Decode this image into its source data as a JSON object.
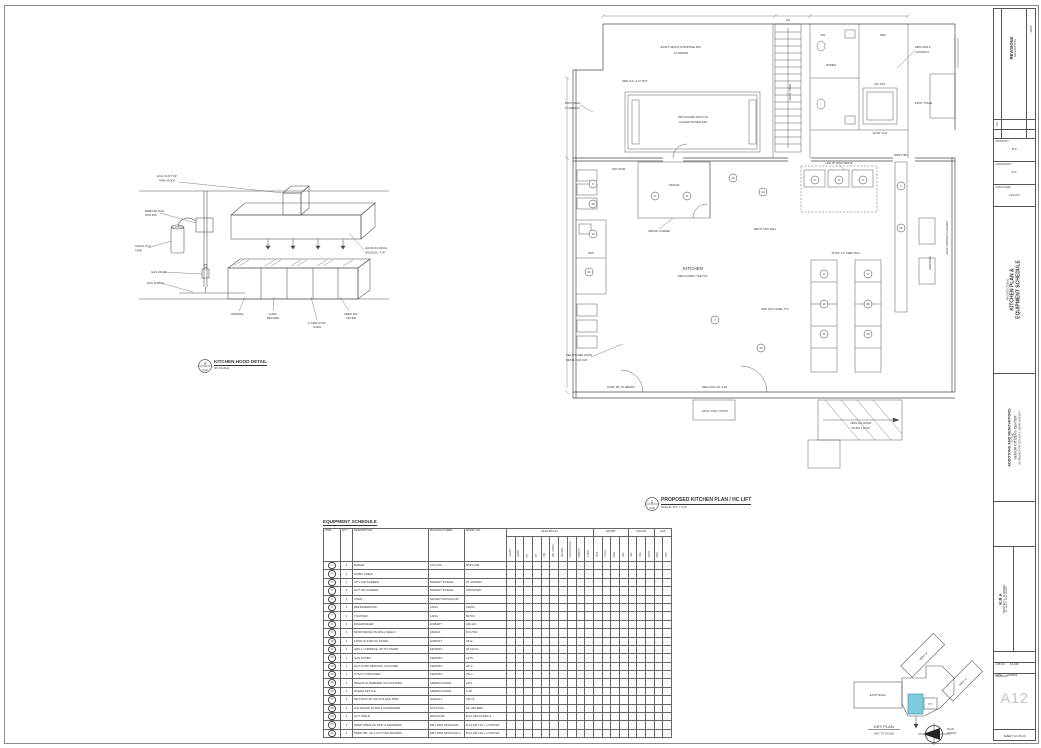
{
  "title_strip": {
    "revisions": {
      "no": "NO.",
      "title": "REVISIONS",
      "description": "DESCRIPTION",
      "date": "DATE"
    },
    "fields": [
      {
        "label": "DRAWN BY",
        "value": "M.F."
      },
      {
        "label": "CHECKED BY",
        "value": "R.K."
      },
      {
        "label": "CADD NAME",
        "value": "A12-KIT"
      }
    ],
    "discipline": "ARCHITECTURAL",
    "sheet_title": [
      "KITCHEN PLAN &",
      "EQUIPMENT SCHEDULE"
    ],
    "project": [
      "ADDITIONS AND RENOVATIONS",
      "TO THE",
      "SENIOR CITIZENS CENTER",
      "BURLINGTON COUNTY, NEW JERSEY"
    ],
    "architect": [
      "K R A",
      "ARCHITECTS - PLANNERS",
      "MT. HOLLY, NEW JERSEY"
    ],
    "job": {
      "label": "JOB NO.",
      "value": "94-026"
    },
    "date": {
      "label": "DATE",
      "value": "10/26/04"
    },
    "drawing_label": "DRAWING",
    "sheet_no": "A12",
    "sheet_of": "SHEET 12 OF 24"
  },
  "hood_detail": {
    "marker": "4",
    "marker_sheet": "A12",
    "caption": "KITCHEN HOOD DETAIL",
    "scale": "NO SCALE",
    "labels": [
      {
        "x": 34,
        "y": 14,
        "t": "EXH. DUCT UP",
        "s": 2.8
      },
      {
        "x": 34,
        "y": 18.5,
        "t": "THRU ROOF",
        "s": 2.8
      },
      {
        "x": 12,
        "y": 49,
        "t": "REMOTE PULL",
        "a": "start",
        "s": 2.8
      },
      {
        "x": 12,
        "y": 53,
        "t": "STATION",
        "a": "start",
        "s": 2.8
      },
      {
        "x": 2,
        "y": 84,
        "t": "ANSUL SYS.",
        "a": "start",
        "s": 2.8
      },
      {
        "x": 2,
        "y": 88.5,
        "t": "TANK",
        "a": "start",
        "s": 2.8
      },
      {
        "x": 18,
        "y": 110,
        "t": "GAS VALVE",
        "a": "start",
        "s": 2.8
      },
      {
        "x": 14,
        "y": 121,
        "t": "GAS SUPPLY",
        "a": "start",
        "s": 2.8
      },
      {
        "x": 232,
        "y": 86,
        "t": "HOOD W/ ANSUL",
        "a": "start",
        "s": 2.8
      },
      {
        "x": 232,
        "y": 90.5,
        "t": "NOZZLES, TYP.",
        "a": "start",
        "s": 2.8
      },
      {
        "x": 104,
        "y": 152,
        "t": "GRIDDLE",
        "s": 2.8
      },
      {
        "x": 140,
        "y": 152,
        "t": "CHAR-",
        "s": 2.8
      },
      {
        "x": 140,
        "y": 156,
        "t": "BROILER",
        "s": 2.8
      },
      {
        "x": 184,
        "y": 161,
        "t": "2-TIER CONV.",
        "s": 2.8
      },
      {
        "x": 184,
        "y": 165,
        "t": "OVEN",
        "s": 2.8
      },
      {
        "x": 218,
        "y": 152,
        "t": "DEEP FAT",
        "s": 2.8
      },
      {
        "x": 218,
        "y": 156,
        "t": "FRYER",
        "s": 2.8
      }
    ]
  },
  "kitchen_plan": {
    "marker": "1",
    "marker_sheet": "A12",
    "caption": "PROPOSED KITCHEN PLAN / HC LIFT",
    "scale": "SCALE: 1/4\" = 1'-0\"",
    "labels": [
      {
        "x": 118,
        "y": 40,
        "t": "EXIST. MULTI-PURPOSE RM.",
        "s": 3
      },
      {
        "x": 118,
        "y": 46,
        "t": "TO REMAIN",
        "s": 2.6
      },
      {
        "x": 130,
        "y": 110,
        "t": "RELOCATED WALK-IN",
        "s": 2.8
      },
      {
        "x": 130,
        "y": 115,
        "t": "COOLER ON NEW PAD",
        "s": 2.6
      },
      {
        "x": 72,
        "y": 74,
        "t": "NEW CLG. & LT. FIXT.",
        "s": 2.6
      },
      {
        "x": 2,
        "y": 96,
        "t": "EXIST. WALL",
        "a": "start",
        "s": 2.6
      },
      {
        "x": 2,
        "y": 101,
        "t": "TO REMAIN",
        "a": "start",
        "s": 2.6
      },
      {
        "x": 228,
        "y": 84,
        "t": "EXIST. STAIR",
        "r": -90,
        "s": 2.6
      },
      {
        "x": 225,
        "y": 13,
        "t": "DN",
        "s": 2.5
      },
      {
        "x": 260,
        "y": 28,
        "t": "JAN.",
        "s": 2.6
      },
      {
        "x": 268,
        "y": 58,
        "t": "WOMEN",
        "s": 2.6
      },
      {
        "x": 320,
        "y": 28,
        "t": "MEN",
        "s": 2.6
      },
      {
        "x": 317,
        "y": 77,
        "t": "H/C LIFT",
        "s": 2.8
      },
      {
        "x": 317,
        "y": 126,
        "t": "42\"x60\" CLR.",
        "s": 2.5
      },
      {
        "x": 352,
        "y": 40,
        "t": "NEW GATE &",
        "a": "start",
        "s": 2.5
      },
      {
        "x": 352,
        "y": 45,
        "t": "CONTROLS",
        "a": "start",
        "s": 2.5
      },
      {
        "x": 352,
        "y": 96,
        "t": "EXIST. STAGE",
        "a": "start",
        "s": 2.6
      },
      {
        "x": 111,
        "y": 178,
        "t": "OFFICE",
        "s": 3
      },
      {
        "x": 56,
        "y": 162,
        "t": "DRY STOR.",
        "s": 2.6
      },
      {
        "x": 28,
        "y": 246,
        "t": "MOP",
        "s": 2.5
      },
      {
        "x": 130,
        "y": 262,
        "t": "KITCHEN",
        "s": 4.6
      },
      {
        "x": 130,
        "y": 269,
        "t": "NEW QUARRY TILE FLR.",
        "s": 2.6
      },
      {
        "x": 283,
        "y": 246,
        "t": "36\"x84\" S.S. PREP TBLS.",
        "s": 2.5
      },
      {
        "x": 276,
        "y": 156,
        "t": "LINE OF HOOD ABOVE",
        "s": 2.5
      },
      {
        "x": 338,
        "y": 148,
        "t": "PASS-THRU",
        "s": 2.5
      },
      {
        "x": 368,
        "y": 255,
        "t": "SERVING",
        "r": -90,
        "s": 3
      },
      {
        "x": 3,
        "y": 348,
        "t": "SEE KITCHEN HOOD",
        "a": "start",
        "s": 2.6
      },
      {
        "x": 3,
        "y": 353,
        "t": "DETAIL THIS SHT.",
        "a": "start",
        "s": 2.6
      },
      {
        "x": 152,
        "y": 380,
        "t": "NEW ALUM. DR. & FR.",
        "s": 2.5
      },
      {
        "x": 58,
        "y": 380,
        "t": "EXIST. DR. TO REMAIN",
        "s": 2.5
      },
      {
        "x": 298,
        "y": 416,
        "t": "NEW H/C RAMP",
        "s": 2.8
      },
      {
        "x": 298,
        "y": 421,
        "t": "SLOPE 1:12 DN.",
        "s": 2.5
      },
      {
        "x": 152,
        "y": 404,
        "t": "EXIST. CONC. STOOP",
        "s": 2.5
      },
      {
        "x": 212,
        "y": 302,
        "t": "NEW VINYL BASE, TYP.",
        "s": 2.5
      },
      {
        "x": 385,
        "y": 230,
        "t": "EXIST. WINDOW TO REMAIN",
        "r": -90,
        "s": 2.5
      },
      {
        "x": 202,
        "y": 222,
        "t": "NEW 8\" CMU WALL",
        "s": 2.5
      },
      {
        "x": 96,
        "y": 224,
        "t": "NEW DR. & FRAME",
        "s": 2.4
      }
    ],
    "callouts": [
      {
        "x": 30,
        "y": 176,
        "n": "6"
      },
      {
        "x": 30,
        "y": 196,
        "n": "15"
      },
      {
        "x": 30,
        "y": 226,
        "n": "12"
      },
      {
        "x": 26,
        "y": 264,
        "n": "21"
      },
      {
        "x": 92,
        "y": 188,
        "n": "5"
      },
      {
        "x": 124,
        "y": 188,
        "n": "8"
      },
      {
        "x": 170,
        "y": 170,
        "n": "16"
      },
      {
        "x": 200,
        "y": 184,
        "n": "14"
      },
      {
        "x": 252,
        "y": 172,
        "n": "2"
      },
      {
        "x": 276,
        "y": 172,
        "n": "3"
      },
      {
        "x": 300,
        "y": 172,
        "n": "4"
      },
      {
        "x": 261,
        "y": 266,
        "n": "9"
      },
      {
        "x": 261,
        "y": 296,
        "n": "10"
      },
      {
        "x": 261,
        "y": 326,
        "n": "11"
      },
      {
        "x": 305,
        "y": 266,
        "n": "17"
      },
      {
        "x": 305,
        "y": 296,
        "n": "18"
      },
      {
        "x": 305,
        "y": 326,
        "n": "19"
      },
      {
        "x": 338,
        "y": 178,
        "n": "1"
      },
      {
        "x": 338,
        "y": 220,
        "n": "20"
      },
      {
        "x": 152,
        "y": 312,
        "n": "7"
      },
      {
        "x": 198,
        "y": 340,
        "n": "13"
      }
    ]
  },
  "equipment_schedule": {
    "title": "EQUIPMENT SCHEDULE",
    "columns": [
      "ITEM",
      "QTY",
      "DESCRIPTION",
      "MANUFACTURER",
      "MODEL NO."
    ],
    "groups": [
      {
        "label": "ELECTRICAL",
        "subs": [
          "VOLTS",
          "AMPS",
          "PH",
          "HP",
          "KW",
          "DIR. CONN.",
          "RECEPT.",
          "CORD & PLUG",
          "SWITCH",
          "J-BOX"
        ]
      },
      {
        "label": "WATER",
        "subs": [
          "HOT",
          "COLD",
          "SIZE",
          "IND."
        ]
      },
      {
        "label": "WASTE",
        "subs": [
          "DIR.",
          "IND.",
          "VENT"
        ]
      },
      {
        "label": "GAS",
        "subs": [
          "SIZE",
          "BTU"
        ]
      }
    ],
    "rows": [
      [
        "1",
        "1",
        "RANGE",
        "VULCAN",
        "60SS-10B"
      ],
      [
        "2",
        "1",
        "WORK SHELF",
        "",
        ""
      ],
      [
        "3",
        "1",
        "CITY AIR SCREEN",
        "MARKET FORGE",
        "KT-1000000"
      ],
      [
        "4",
        "4",
        "HOT AIR SCREEN",
        "MARKET FORGE",
        "UNKNOWN"
      ],
      [
        "5",
        "1",
        "OVEN",
        "MAGIKITCH'N EQUIP.",
        ""
      ],
      [
        "6",
        "1",
        "REFRIGERATOR",
        "LANG",
        "K2000"
      ],
      [
        "7",
        "1",
        "TOASTER",
        "LANG",
        "B470U"
      ],
      [
        "8",
        "1",
        "DISHWASHER",
        "HOBART",
        "AM-14C"
      ],
      [
        "9",
        "1",
        "MICROWAVE ON WALL SHELF",
        "AMANA",
        "RC17SD"
      ],
      [
        "10",
        "1",
        "FOOD SLICER W/ STAND",
        "HOBART",
        "2912"
      ],
      [
        "11",
        "1",
        "GRILL / GRIDDLE, 36\" W/ STAND",
        "KEATING",
        "36 FLD-E"
      ],
      [
        "12",
        "1",
        "GAS FRYER",
        "KEATING",
        "14TS"
      ],
      [
        "13",
        "1",
        "HOT FOOD SERVING COUNTER",
        "KEATING",
        "HF-4"
      ],
      [
        "14",
        "1",
        "UTILITY DISPOSER",
        "KEATING",
        "UD-1"
      ],
      [
        "15",
        "1",
        "REACH-IN FREEZER ON CASTERS",
        "AMERIKOOLER",
        "FR-1"
      ],
      [
        "16",
        "1",
        "STEAM KETTLE",
        "AMERIKOOLER",
        "K-60"
      ],
      [
        "17",
        "1",
        "MILK BOX W/ COLD PLATE TRIM",
        "DUNHILL",
        "TM-74"
      ],
      [
        "18",
        "1",
        "ICE MAKER W/ BIN & DISPENSER",
        "NATIONAL",
        "ML-350-MED"
      ],
      [
        "19",
        "1",
        "HOT TABLE",
        "MODULAR",
        "B-12-MFCM-SRA-4"
      ],
      [
        "20",
        "1",
        "PREP TABLE W/ SINK & DRAWERS",
        "MET-PRO MODULAR",
        "B-12-MFT-SL + CUSTOM"
      ],
      [
        "21",
        "1",
        "PREP TBL. W/ 2 CUTTING BOARDS",
        "MET-PRO MODULAR 1",
        "B-12-MFT-SL + CUSTOM"
      ]
    ]
  },
  "key_plan": {
    "label": "KEY PLAN",
    "scale": "NOT TO SCALE",
    "north_line1": "PLAN",
    "north_line2": "NORTH",
    "wings": [
      "EXIST. BLDG.",
      "WING 'B'",
      "WING 'C'",
      "KIT."
    ],
    "highlight_color": "#7fcbe0"
  }
}
